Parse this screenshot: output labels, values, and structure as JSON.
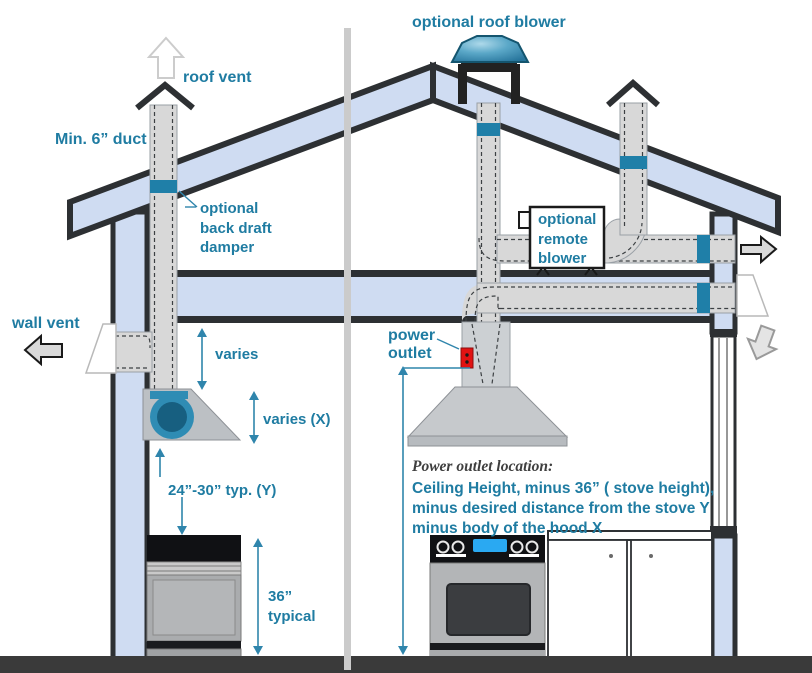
{
  "diagram": {
    "labels": {
      "roof_blower": "optional roof blower",
      "roof_vent": "roof vent",
      "min_duct": "Min. 6” duct",
      "back_draft_1": "optional",
      "back_draft_2": "back draft",
      "back_draft_3": "damper",
      "wall_vent": "wall vent",
      "varies": "varies",
      "varies_x": "varies (X)",
      "typ_y": "24”-30” typ. (Y)",
      "t36_1": "36”",
      "t36_2": "typical",
      "power_1": "power",
      "power_2": "outlet",
      "remote_1": "optional",
      "remote_2": "remote",
      "remote_3": "blower",
      "note_title": "Power outlet location:",
      "note_1": "Ceiling Height, minus 36” ( stove height),",
      "note_2": "minus desired distance  from the stove Y",
      "note_3": "minus  body of the hood X"
    },
    "colors": {
      "accent_teal_text": "#1f7ca2",
      "damper_teal": "#1f7fa8",
      "dimension_teal": "#2f85ac",
      "roof_wall_fill": "#cfdcf2",
      "outline_dark": "#2d3033",
      "duct_gray": "#d8d8d8",
      "outlet_red": "#e11212",
      "floor_dark": "#3a3a3a",
      "display_blue": "#2aa9f2",
      "hood_blower_teal": "#2f8cb4"
    }
  }
}
